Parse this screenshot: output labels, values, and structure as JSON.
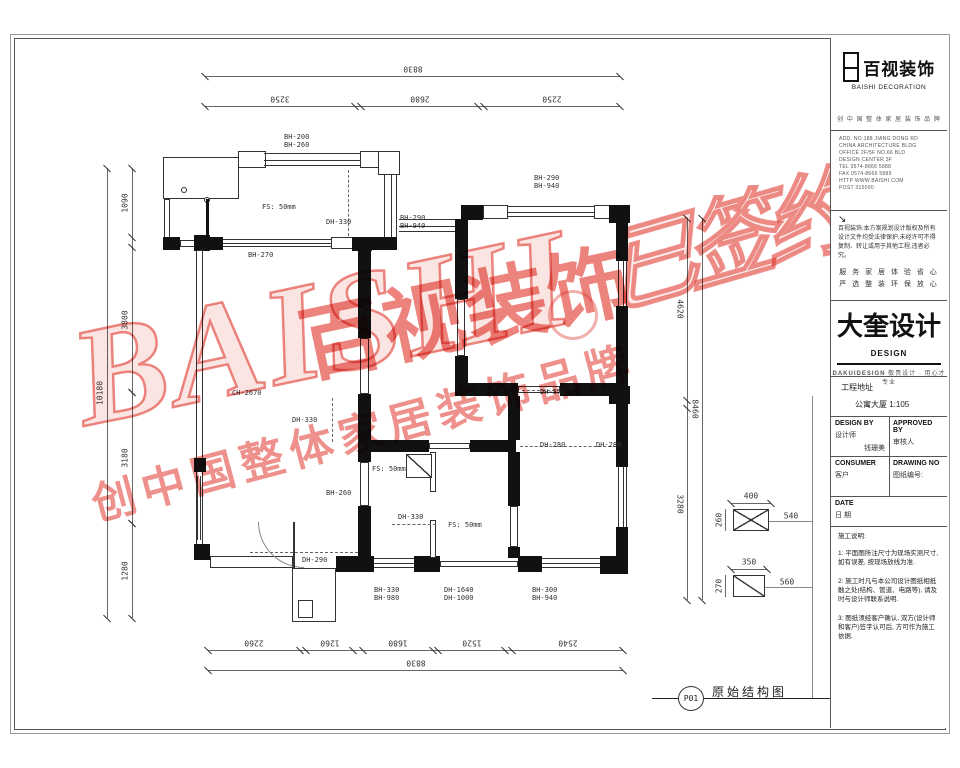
{
  "sheet": {
    "page": "P01",
    "title": "原始结构图"
  },
  "company": {
    "name": "百视装饰",
    "name_en": "BAISHI  DECORATION",
    "tagline": "创 中 国 整 体 家 居 装 饰 品 牌",
    "address_lines": [
      "ADD. NO.188 JIANG DONG RD",
      "CHINA ARCHITECTURE BLDG",
      "OFFICE 2F/5F NO.66 BLD",
      "DESIGN CENTER 3F",
      "TEL 0574-8666 5888",
      "FAX 0574-8666 5889",
      "HTTP WWW.BAISHI.COM",
      "POST 315000"
    ],
    "notice_arrow": "↘",
    "notice": "百视装饰:本方案规划设计版权及所有设计文件均受法律保护,未经许可不得复制、转让或用于其他工程,违者必究。",
    "slogan1": "服 务 家 居 体 验 省 心",
    "slogan2": "严 选 整 装 环 保 放 心"
  },
  "studio": {
    "name": "大奎设计",
    "en": "DESIGN",
    "sub": "DAKUIDESIGN",
    "slogan": "敬畏设计 · 用心才专业"
  },
  "project": {
    "row1": "工程地址",
    "row2": "公寓大厦 1:105"
  },
  "fields": {
    "design_by_en": "DESIGN BY",
    "design_by_cn": "设计师",
    "designer": "钱珊美",
    "approved_en": "APPROVED BY",
    "approved_cn": "审核人",
    "consumer_en": "CONSUMER",
    "consumer_cn": "客户",
    "drawing_no_en": "DRAWING NO",
    "drawing_no_cn": "图纸编号:",
    "date_en": "DATE",
    "date_cn": "日 期"
  },
  "notes": {
    "title": "施工说明:",
    "items": [
      "1: 平面图所注尺寸为现场实测尺寸, 如有误差, 按现场放线为准.",
      "2: 施工时凡与本公司设计图纸相抵触之处(结构、管道、电路等), 请及时与设计师联系说明.",
      "3: 图纸须经客户确认, 双方(设计师和客户)签字认可后, 方可作为施工依据."
    ]
  },
  "watermark": {
    "latin": "BAISHI",
    "brand": "百视装饰",
    "signed": "已签约",
    "slogan": "创中国整体家居装饰品牌",
    "color": "#e23a30"
  },
  "plan": {
    "labels": [
      {
        "l1": "BH-200",
        "l2": "BH-260",
        "x": 284,
        "y": 133
      },
      {
        "l1": "FS: 50mm",
        "x": 262,
        "y": 203
      },
      {
        "l1": "DH-330",
        "x": 326,
        "y": 218
      },
      {
        "l1": "BH-290",
        "l2": "BH-940",
        "x": 400,
        "y": 214
      },
      {
        "l1": "BH-290",
        "l2": "BH-940",
        "x": 534,
        "y": 174
      },
      {
        "l1": "BH-270",
        "x": 248,
        "y": 251
      },
      {
        "l1": "CH-2670",
        "x": 232,
        "y": 389
      },
      {
        "l1": "DH-330",
        "x": 292,
        "y": 416
      },
      {
        "l1": "DH-370",
        "x": 540,
        "y": 388
      },
      {
        "l1": "DH-280",
        "x": 540,
        "y": 441
      },
      {
        "l1": "DH-280",
        "x": 596,
        "y": 441
      },
      {
        "l1": "BH-260",
        "x": 326,
        "y": 489
      },
      {
        "l1": "FS: 50mm",
        "x": 372,
        "y": 465
      },
      {
        "l1": "DH-330",
        "x": 398,
        "y": 513
      },
      {
        "l1": "FS: 50mm",
        "x": 448,
        "y": 521
      },
      {
        "l1": "DH-290",
        "x": 302,
        "y": 556
      },
      {
        "l1": "BH-330",
        "l2": "BH-980",
        "x": 374,
        "y": 586
      },
      {
        "l1": "DH-1640",
        "l2": "DH-1000",
        "x": 444,
        "y": 586
      },
      {
        "l1": "BH-300",
        "l2": "BH-940",
        "x": 532,
        "y": 586
      }
    ],
    "dims": {
      "top": {
        "overall": "8830",
        "segments": [
          "3250",
          "2680",
          "2250"
        ]
      },
      "bottom": {
        "overall": "8830",
        "segments": [
          "2260",
          "1260",
          "1680",
          "1520",
          "2540"
        ]
      },
      "left": {
        "overall": "10180",
        "segments": [
          "1090",
          "3800",
          "3180",
          "1280"
        ]
      },
      "right": {
        "overall": "8460",
        "segments": [
          "4620",
          "3280"
        ]
      }
    },
    "callouts": [
      {
        "width_label": "400",
        "height_label": "260",
        "offset_label": "540"
      },
      {
        "width_label": "350",
        "height_label": "270",
        "offset_label": "560"
      }
    ]
  }
}
